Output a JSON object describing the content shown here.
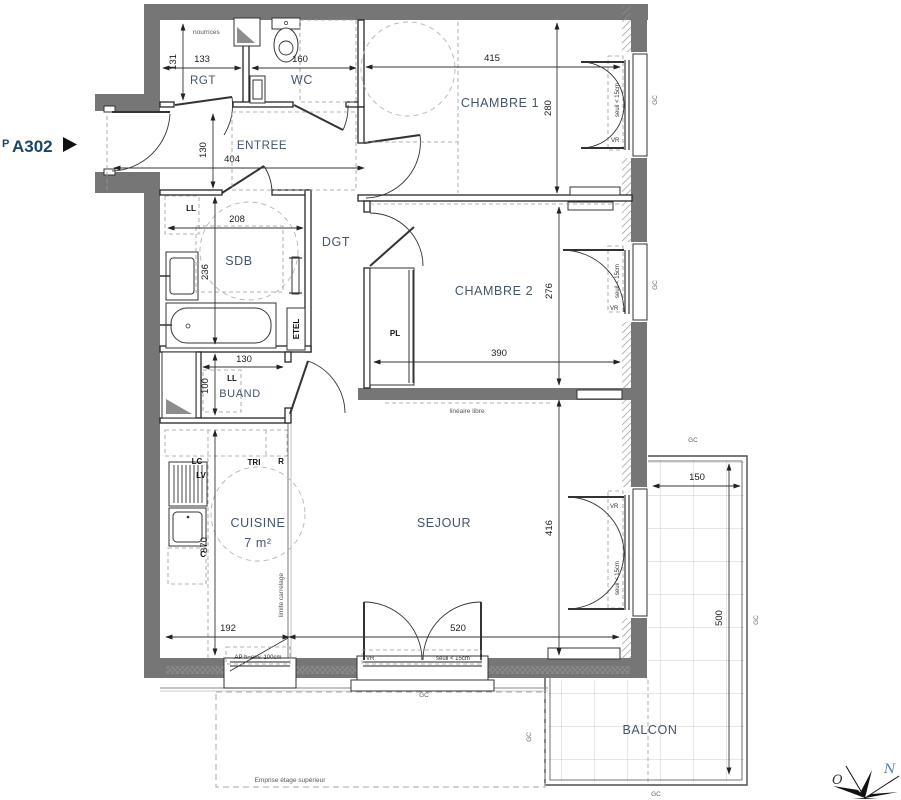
{
  "unit": {
    "prefix": "P",
    "number": "A302"
  },
  "rooms": {
    "rgt": "RGT",
    "wc": "WC",
    "chambre1": "CHAMBRE 1",
    "entree": "ENTREE",
    "sdb": "SDB",
    "dgt": "DGT",
    "chambre2": "CHAMBRE 2",
    "buand": "BUAND",
    "cuisine": "CUISINE",
    "cuisine_area": "7 m²",
    "sejour": "SEJOUR",
    "balcon": "BALCON"
  },
  "dims": {
    "rgt_w": "133",
    "rgt_h": "131",
    "wc_w": "160",
    "ch1_w": "415",
    "ch1_h": "280",
    "entree_h": "130",
    "entree_w": "404",
    "sdb_w": "208",
    "sdb_h": "236",
    "buand_w": "130",
    "buand_h": "100",
    "ch2_w": "390",
    "ch2_h": "276",
    "sejour_w": "520",
    "sejour_h": "416",
    "cuisine_w": "192",
    "cuisine_h": "370",
    "balcon_w": "150",
    "balcon_h": "500"
  },
  "annot": {
    "nourrices": "nourrices",
    "ll": "LL",
    "etel": "ETEL",
    "pl": "PL",
    "lc": "LC",
    "tri": "TRI",
    "r": "R",
    "lv": "LV",
    "c": "C",
    "lineaire": "linéaire libre",
    "carrelage": "limite carrelage",
    "ap": "AP h=env. 100cm",
    "emprise": "Emprise étage supérieur",
    "seuil": "seuil < 15cm",
    "vr": "VR",
    "gc": "GC"
  },
  "compass": {
    "n": "N",
    "o": "O"
  },
  "colors": {
    "wall": "#767676",
    "accent": "#1c4566",
    "label": "#44546a"
  }
}
